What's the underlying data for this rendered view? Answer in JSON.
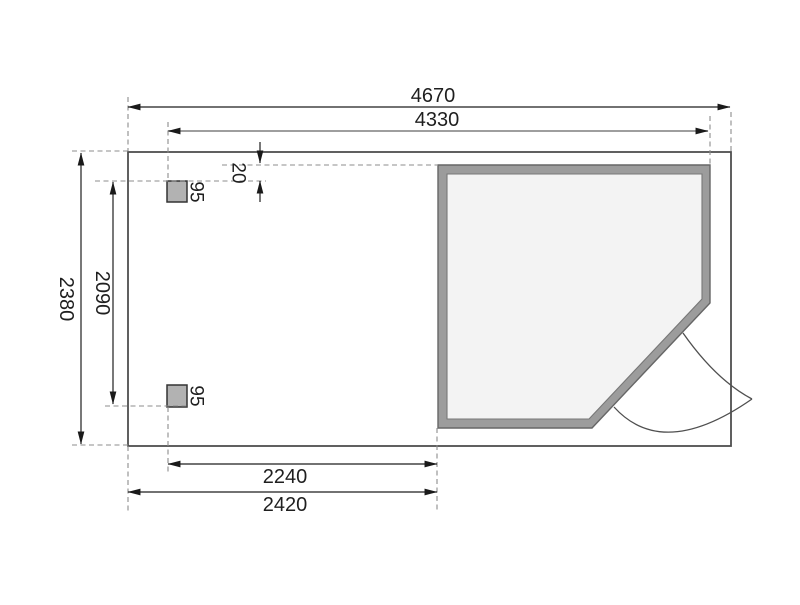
{
  "drawing": {
    "title": "floor-plan",
    "dims": {
      "overall_width": "4670",
      "house_width": "4330",
      "overall_depth": "2380",
      "post_spacing": "2090",
      "wall_gap": "20",
      "post_size_top": "95",
      "post_size_bottom": "95",
      "annex_post_width": "2240",
      "annex_width": "2420"
    },
    "colors": {
      "background": "#ffffff",
      "line": "#1f1f1f",
      "secondary_dim_line": "#9e9e9e",
      "extension_dash": "#8c8c8c",
      "building_outline": "#4f4f4f",
      "wall_fill": "#9c9c9c",
      "wall_edge": "#666666",
      "interior_fill": "#f3f3f3",
      "interior_edge": "#777777",
      "post_fill": "#b2b2b2",
      "post_edge": "#333333"
    }
  }
}
